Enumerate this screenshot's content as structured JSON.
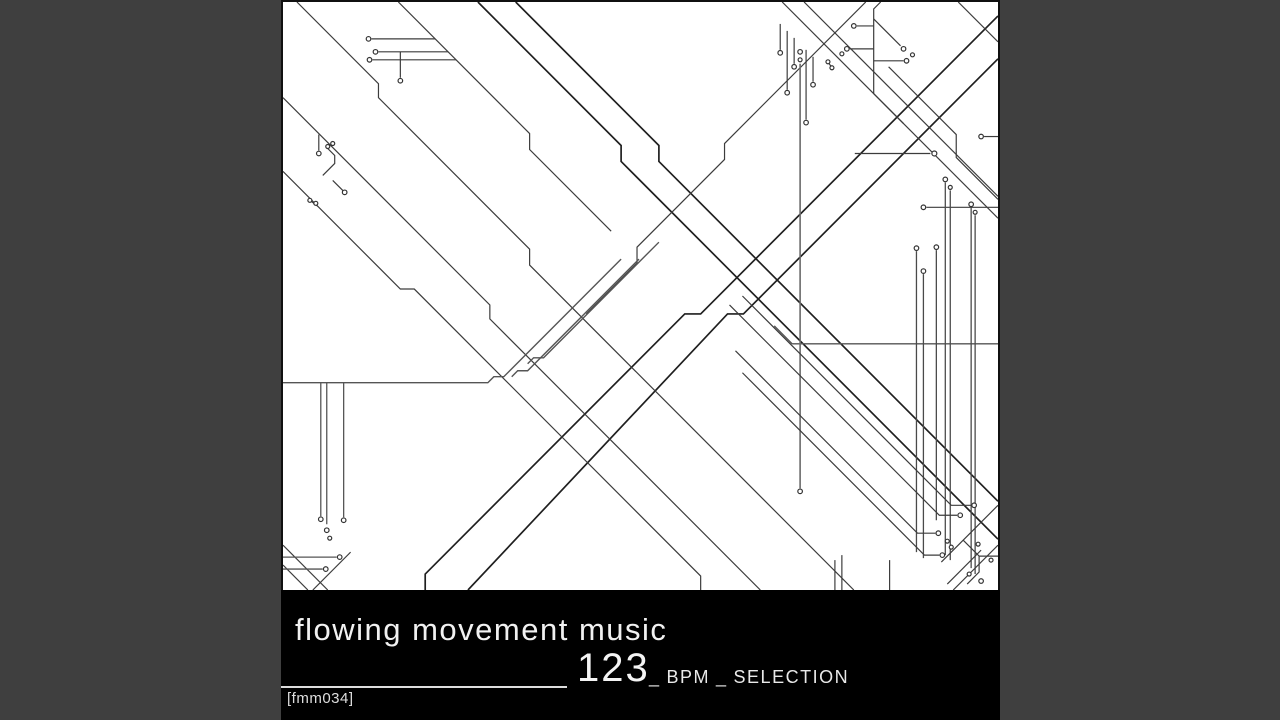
{
  "window": {
    "background_color": "#3f3f3f"
  },
  "album_cover": {
    "art_description": "black-and-white circuit-trace line art forming a large X",
    "canvas_color": "#ffffff",
    "line_color": "#3a3a3a",
    "caption": {
      "background_color": "#000000",
      "text_color": "#f1f1f1",
      "label_name": "flowing movement music",
      "bpm_number": "123",
      "separator_left": "_",
      "bpm_label": "BPM",
      "separator_right": "_",
      "selection_label": "SELECTION",
      "catalog_number": "[fmm034]"
    }
  }
}
